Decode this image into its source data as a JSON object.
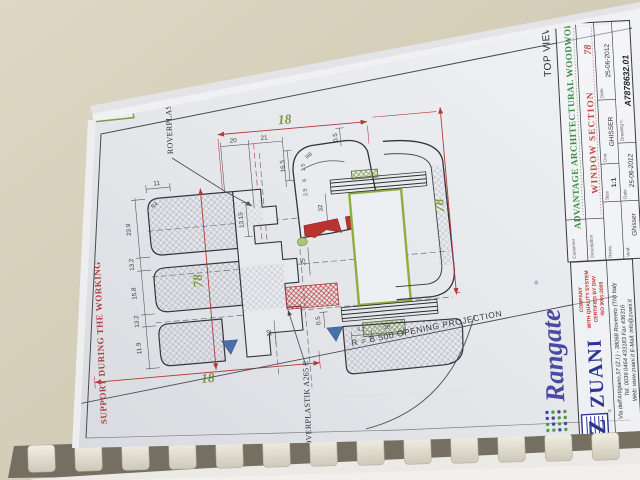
{
  "scene": {
    "background_color": "#d9d3bf",
    "paper_color": "#e9eaee"
  },
  "drawing": {
    "drw_no": "Drw.no. 1",
    "roverplastik_top": "ROVERPLASTIK A252 E",
    "roverplastik_bottom": "ROVERPLASTIK A265 E",
    "support_note": "SUPPORT DURING THE WORKING",
    "opening_projection": "R  =  B 500    OPENING PROJECTION",
    "green_dims": {
      "top": "18",
      "right": "78",
      "middle": "78",
      "bottom": "18"
    },
    "dims": {
      "d11": "11",
      "d20": "20",
      "d21": "21",
      "d13_15": "13.15",
      "d0_5_top": "0.5",
      "d16_5": "16.5",
      "d3_5": "3.5",
      "d6": "6",
      "d2_5": "2.5",
      "d25": "25",
      "d32": "32",
      "d12": "12",
      "d0_5_bottom": "0.5",
      "d5_2": "5.2",
      "d20_bottom": "20",
      "r8": "R8",
      "r4": "R4",
      "left_chain": [
        "23.9",
        "13.2",
        "15.8",
        "13.2",
        "11.9"
      ]
    }
  },
  "title_block": {
    "top_view": "TOP VIEW",
    "customer_label": "Customer",
    "description_label": "Description",
    "revision_label": "Revis.",
    "verif_label": "Verif.",
    "title": "ADVANTAGE ARCHITECTURAL WOODWORK",
    "subtitle": "WINDOW SECTION",
    "subtitle_number": "78",
    "size_label": "Size",
    "size_value": "1:1",
    "drw_label": "Drw.",
    "drw_value": "GHISSER",
    "date_label": "Date",
    "date_value": "25-06-2012",
    "verif_value": "Ghisser",
    "verif_date_value": "25-06-2012",
    "drawing_n_label": "Drawing n.",
    "drawing_n_value": "A7878632.01"
  },
  "zuani": {
    "brand": "ZUANI",
    "registered": "®",
    "cert_line1": "COMPANY",
    "cert_line2": "WITH QUALITY SYSTEM",
    "cert_line3": "CERTIFIED BY DNV",
    "cert_line4": "ISO 9001:2000",
    "address_line1": "Via dell'Artigiano,57 (Z.I.)  -  38068 Rovereto (TN) Italy",
    "address_line2": "Tel. 0039 0464 433183   Fax 436316",
    "address_line3": "Web: www.zuani.it    E-Mail: info@zuani.it"
  },
  "rangate": {
    "brand": "Rangate",
    "registered": "®"
  }
}
